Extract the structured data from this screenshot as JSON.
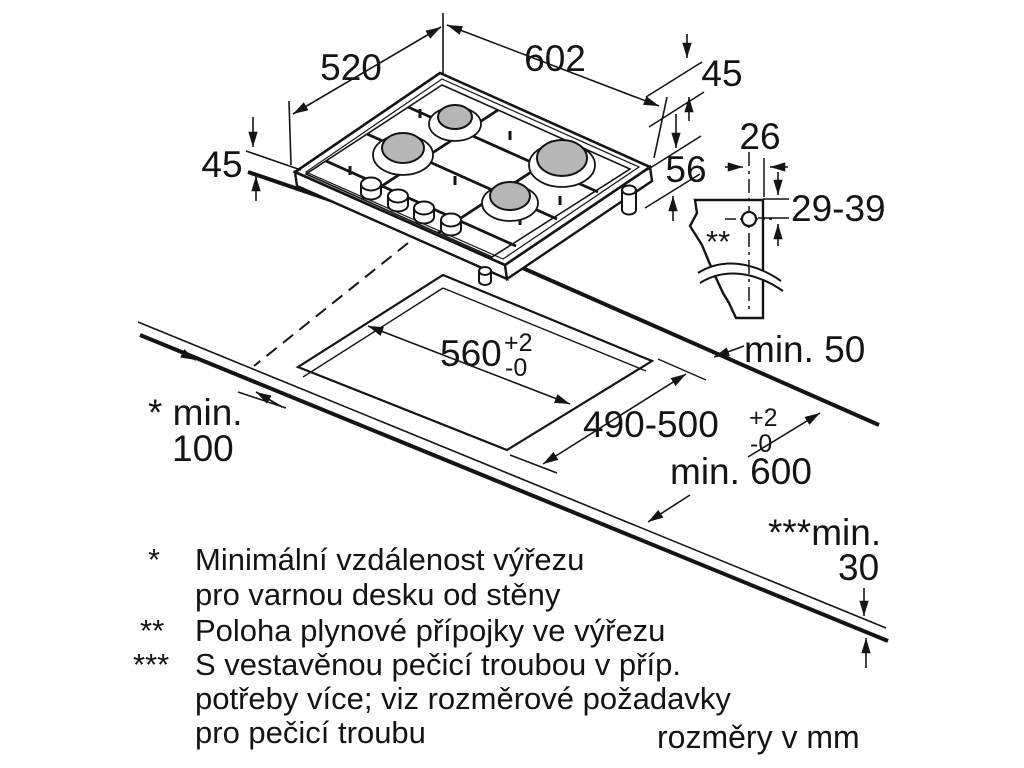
{
  "title": "Gas hob installation dimension diagram",
  "units_note": "rozměry v mm",
  "colors": {
    "line": "#141414",
    "burner_fill": "#b6b6b6",
    "background": "#ffffff"
  },
  "dims": {
    "hob_depth": "520",
    "hob_width": "602",
    "hob_height_left": "45",
    "hob_height_right": "45",
    "hob_total_height": "56",
    "gas_offset_h": "26",
    "gas_offset_v": "29-39",
    "gas_marker": "**",
    "cutout_width": "560",
    "cutout_width_plus": "+2",
    "cutout_width_minus": "-0",
    "cutout_depth": "490-500",
    "cutout_depth_plus": "+2",
    "cutout_depth_minus": "-0",
    "min_rear": "min. 50",
    "min_side_label": "* min.",
    "min_side_value": "100",
    "min_worktop_depth": "min. 600",
    "min_front_label": "***min.",
    "min_front_value": "30"
  },
  "footnotes": {
    "star": {
      "marker": "*",
      "line1": "Minimální vzdálenost výřezu",
      "line2": "pro varnou desku od stěny"
    },
    "double_star": {
      "marker": "**",
      "line1": "Poloha plynové přípojky ve výřezu"
    },
    "triple_star": {
      "marker": "***",
      "line1": "S vestavěnou pečicí troubou v příp.",
      "line2": "potřeby více; viz rozměrové požadavky",
      "line3": "pro pečicí troubu"
    }
  }
}
